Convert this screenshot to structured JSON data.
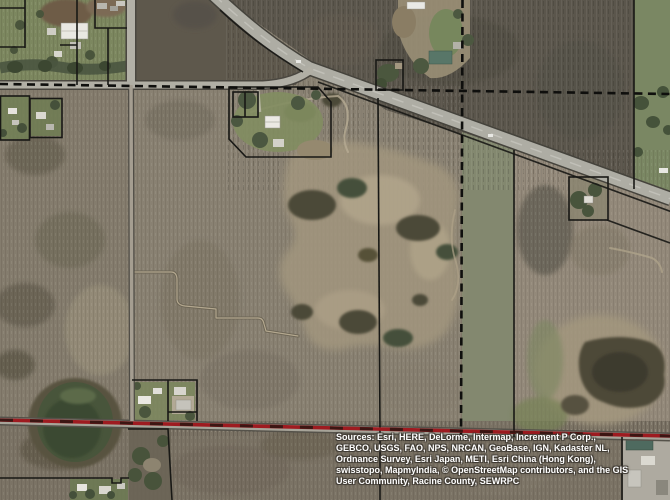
{
  "map": {
    "attribution": {
      "lines": [
        "Sources: Esri, HERE, DeLorme, Intermap, Increment P Corp.,",
        "GEBCO, USGS, FAO, NPS, NRCAN, GeoBase, IGN, Kadaster NL,",
        "Ordnance Survey, Esri Japan, METI, Esri China (Hong Kong),",
        "swisstopo, MapmyIndia, © OpenStreetMap contributors, and the GIS",
        "User Community, Racine County, SEWRPC"
      ]
    },
    "colors": {
      "boundary_red": "#9e1b20",
      "parcel_line": "#181815",
      "section_line": "#0f0f0d",
      "road_surface": "#aeada4",
      "field_green": "#7c875f",
      "field_brown": "#898172",
      "field_dark": "#5b564c",
      "pond_green": "#48553b",
      "attribution_text": "#ffffff"
    }
  }
}
